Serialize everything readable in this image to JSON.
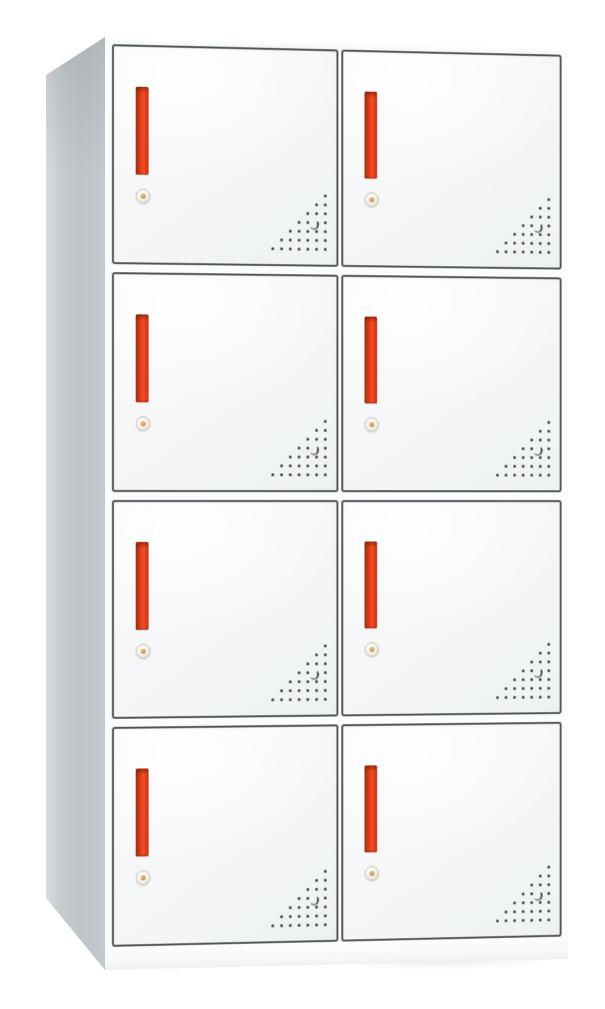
{
  "scene": {
    "object": "8-door metal locker cabinet",
    "view": "three-quarter front view, left side panel visible",
    "background_color": "#ffffff"
  },
  "cabinet": {
    "rows": 4,
    "columns": 2,
    "door_count": 8,
    "features_per_door": {
      "handle": "vertical red recessed handle, upper-left of door",
      "lock": "round keyed cam lock below handle",
      "vents": "triangular cluster of perforation holes in bottom-right corner"
    },
    "vent_pattern": {
      "rows": 7,
      "row_counts": [
        1,
        2,
        3,
        4,
        5,
        6,
        7
      ],
      "spacing_px": 9,
      "dot_px": 3,
      "crescent": {
        "row": 4,
        "col": 1
      }
    },
    "colors": {
      "side_panel": "#c4c9cc",
      "side_panel_light": "#dadde0",
      "front_body": "#fbfcfd",
      "door_face": "#f9fafb",
      "door_face_shade": "#eef1f2",
      "door_frame": "#515558",
      "handle_dark": "#9a2d0e",
      "handle_mid": "#c43512",
      "handle_main": "#e64019",
      "handle_bright": "#f14f27",
      "lock_ring": "#c6c1b0",
      "lock_face": "#f2efe7",
      "lock_pin": "#cf9a55",
      "vent_dot": "#3e4245",
      "shadow": "rgba(140,150,157,0.16)"
    }
  }
}
